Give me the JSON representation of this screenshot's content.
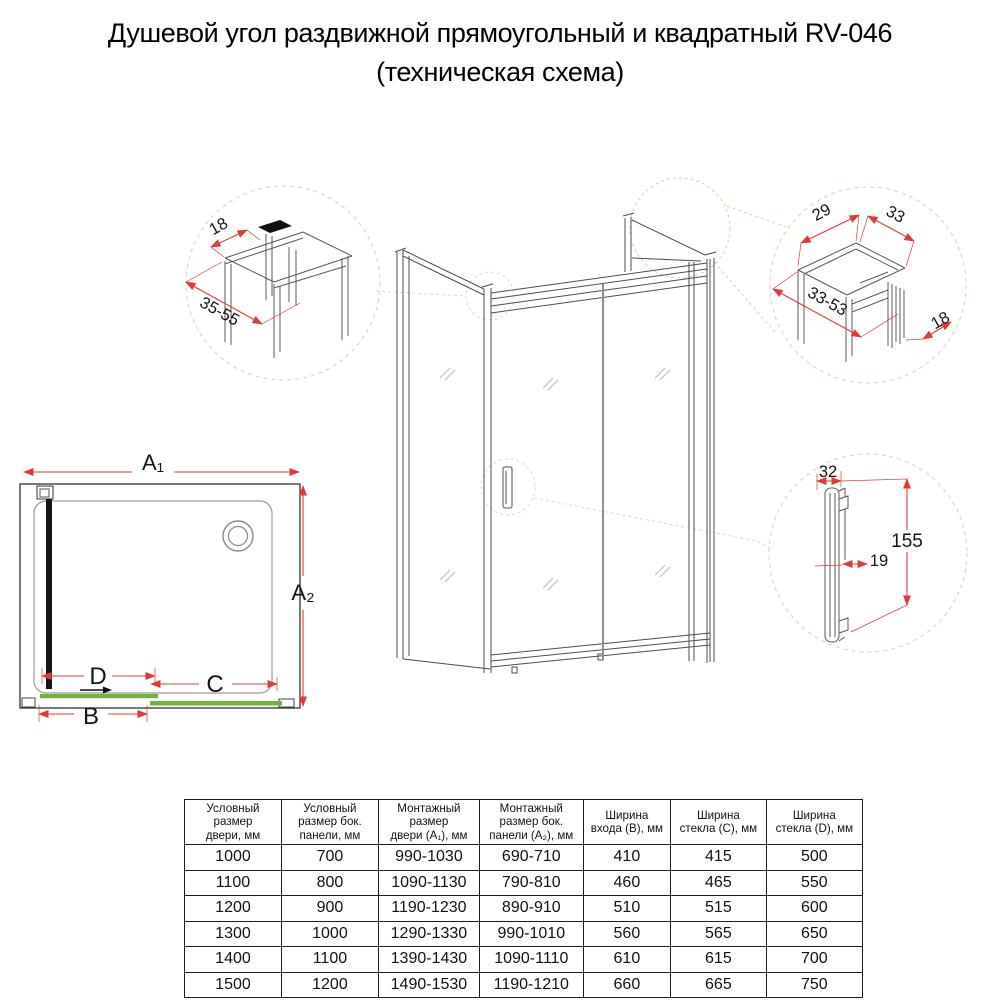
{
  "title": {
    "line1": "Душевой угол раздвижной прямоугольный и квадратный RV-046",
    "line2": "(техническая схема)"
  },
  "colors": {
    "dimension_red": "#e03a3a",
    "glass_green": "#74b33e",
    "leader_gray": "#d0d0d0",
    "leader_tan": "#e8c9a0",
    "sketch_line": "#4d4d4d"
  },
  "detail_top_left": {
    "dim_18": "18",
    "dim_35_55": "35-55"
  },
  "detail_top_right": {
    "dim_29": "29",
    "dim_33": "33",
    "dim_33_53": "33-53",
    "dim_18": "18"
  },
  "detail_handle": {
    "dim_32": "32",
    "dim_155": "155",
    "dim_19": "19"
  },
  "plan": {
    "dim_a1": "A₁",
    "dim_a2": "A₂",
    "dim_b": "B",
    "dim_c": "C",
    "dim_d": "D"
  },
  "table": {
    "headers": [
      "Условный\nразмер\nдвери, мм",
      "Условный\nразмер бок.\nпанели, мм",
      "Монтажный\nразмер\nдвери (А₁), мм",
      "Монтажный\nразмер бок.\nпанели (А₂), мм",
      "Ширина\nвхода (B), мм",
      "Ширина\nстекла (C), мм",
      "Ширина\nстекла (D), мм"
    ],
    "rows": [
      [
        "1000",
        "700",
        "990-1030",
        "690-710",
        "410",
        "415",
        "500"
      ],
      [
        "1100",
        "800",
        "1090-1130",
        "790-810",
        "460",
        "465",
        "550"
      ],
      [
        "1200",
        "900",
        "1190-1230",
        "890-910",
        "510",
        "515",
        "600"
      ],
      [
        "1300",
        "1000",
        "1290-1330",
        "990-1010",
        "560",
        "565",
        "650"
      ],
      [
        "1400",
        "1100",
        "1390-1430",
        "1090-1110",
        "610",
        "615",
        "700"
      ],
      [
        "1500",
        "1200",
        "1490-1530",
        "1190-1210",
        "660",
        "665",
        "750"
      ]
    ]
  }
}
